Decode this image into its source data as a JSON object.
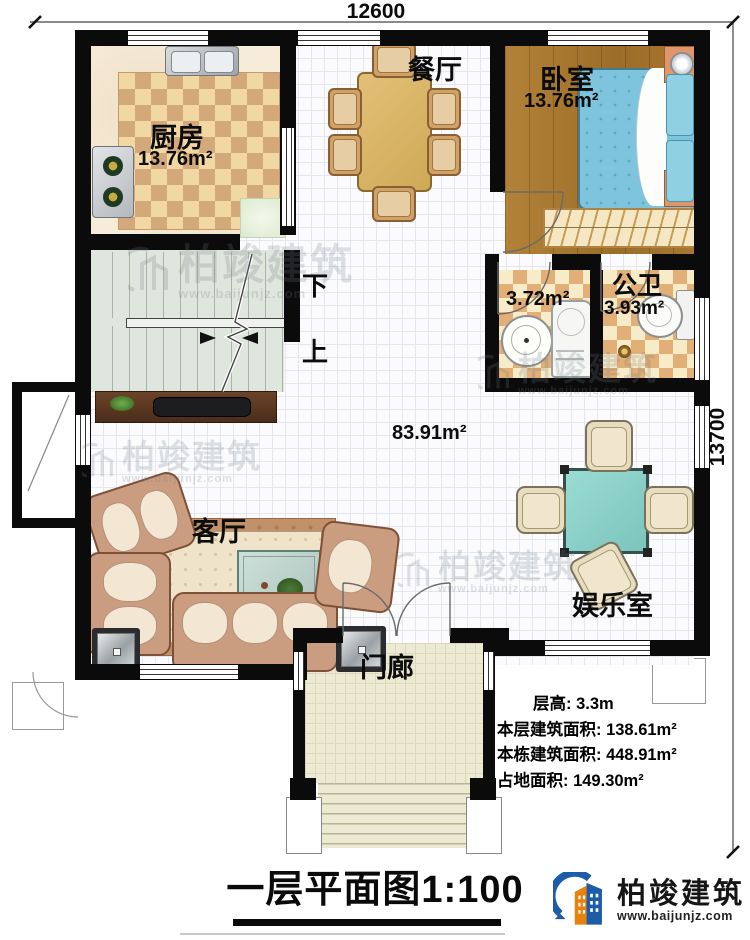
{
  "dimensions": {
    "width_label": "12600",
    "height_label": "13700"
  },
  "rooms": {
    "kitchen": {
      "name": "厨房",
      "area": "13.76m²"
    },
    "dining": {
      "name": "餐厅"
    },
    "bedroom": {
      "name": "卧室",
      "area": "13.76m²"
    },
    "bath_small": {
      "area": "3.72m²"
    },
    "bath_public": {
      "name": "公卫",
      "area": "3.93m²"
    },
    "hall": {
      "area": "83.91m²"
    },
    "living": {
      "name": "客厅"
    },
    "entertainment": {
      "name": "娱乐室"
    },
    "porch": {
      "name": "门廊"
    },
    "stairs": {
      "down_label": "下",
      "up_label": "上"
    }
  },
  "stats": [
    "层高: 3.3m",
    "本层建筑面积: 138.61m²",
    "本栋建筑面积: 448.91m²",
    "占地面积: 149.30m²"
  ],
  "title": {
    "text": "一层平面图",
    "scale": "1:100"
  },
  "branding": {
    "logo_name": "柏竣建筑",
    "logo_url": "www.baijunjz.com"
  },
  "watermark": {
    "name": "柏竣建筑",
    "url": "www.baijunjz.com"
  },
  "colors": {
    "accent_blue": "#1d5da8",
    "accent_orange": "#e8820c",
    "wall": "#0b0b0b"
  }
}
